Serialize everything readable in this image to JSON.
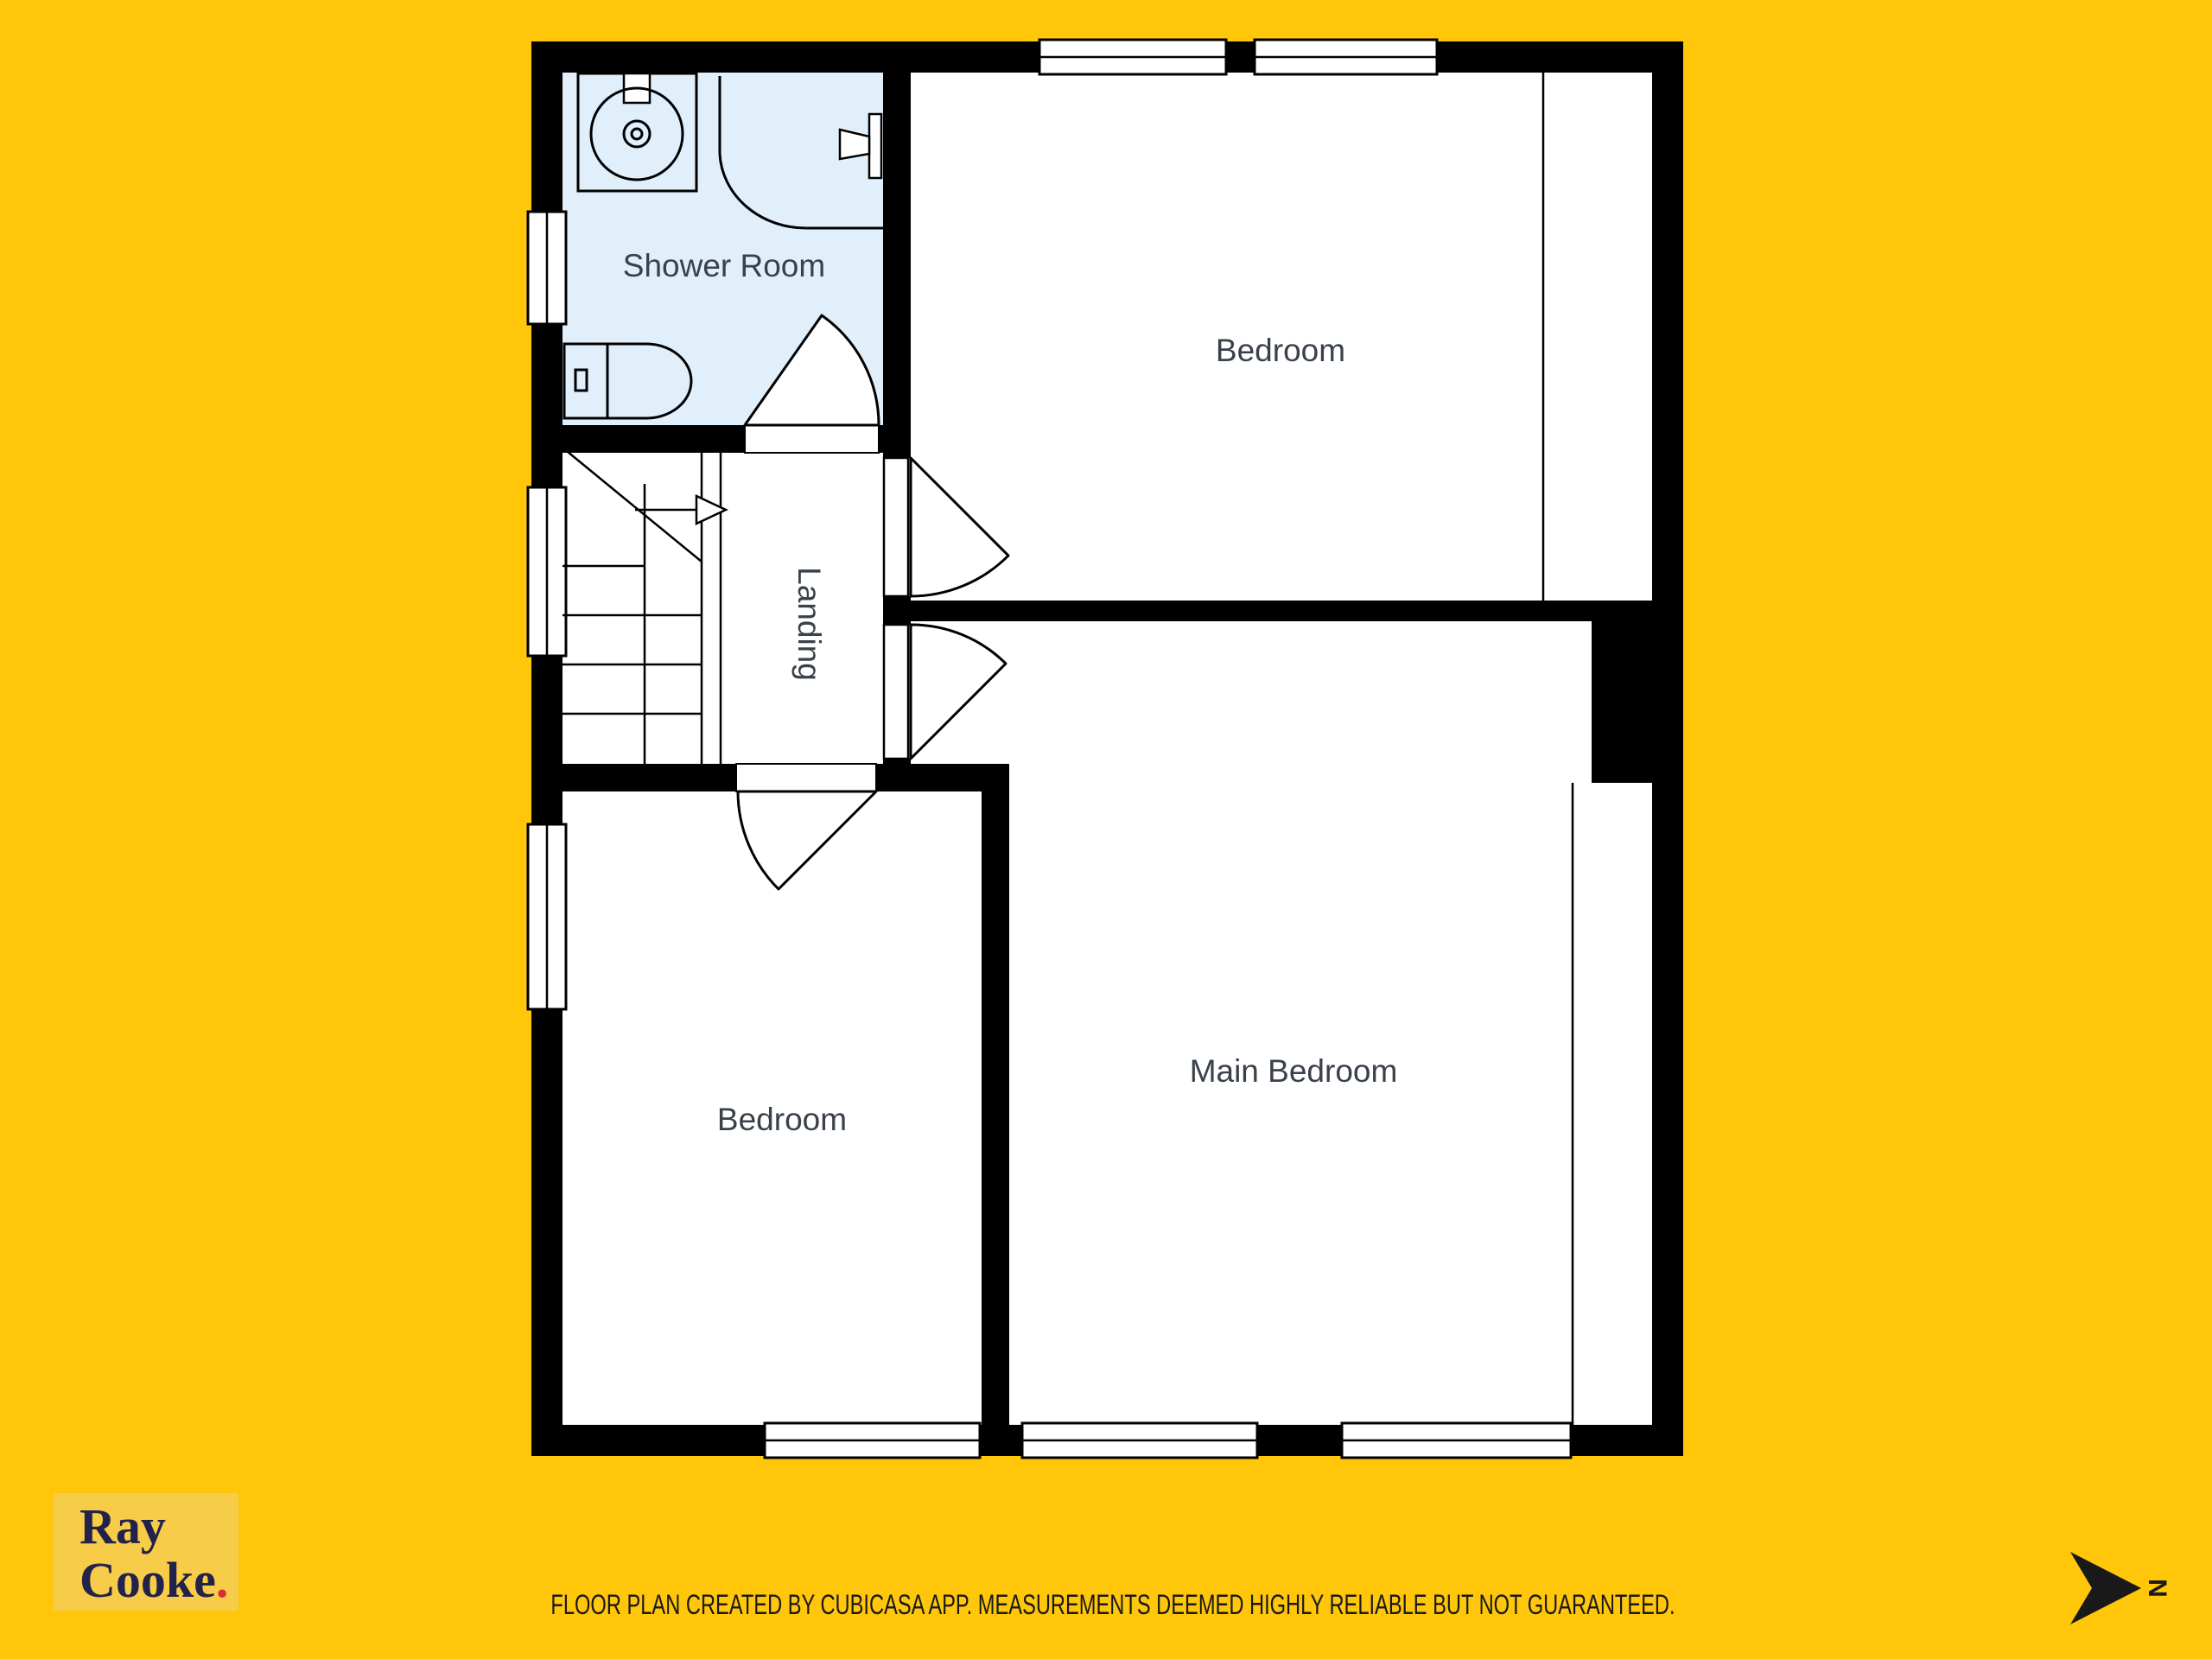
{
  "colors": {
    "bg": "#FFC60A",
    "wall": "#000000",
    "room": "#FFFFFF",
    "wet_room": "#E1EFFB",
    "label": "#3A414B",
    "ink": "#191919",
    "logo_bg": "#F7CC49",
    "logo_text": "#23224A",
    "accent": "#D62E34"
  },
  "floor_plan": {
    "type": "upper-floor plan",
    "rooms": [
      {
        "id": "shower-room",
        "label": "Shower Room"
      },
      {
        "id": "bedroom-top-right",
        "label": "Bedroom"
      },
      {
        "id": "landing",
        "label": "Landing"
      },
      {
        "id": "bedroom-bottom-left",
        "label": "Bedroom"
      },
      {
        "id": "main-bedroom",
        "label": "Main Bedroom"
      }
    ],
    "fixtures": [
      "sink-icon",
      "shower-icon",
      "toilet-icon",
      "staircase",
      "door-swings",
      "windows"
    ]
  },
  "branding": {
    "agency_line1": "Ray",
    "agency_line2": "Cooke",
    "accent_dot": "."
  },
  "compass": {
    "label": "N",
    "icon": "north-arrow-pointing-right"
  },
  "footer": {
    "disclaimer": "FLOOR PLAN CREATED BY CUBICASA APP. MEASUREMENTS DEEMED HIGHLY RELIABLE BUT NOT GUARANTEED."
  }
}
